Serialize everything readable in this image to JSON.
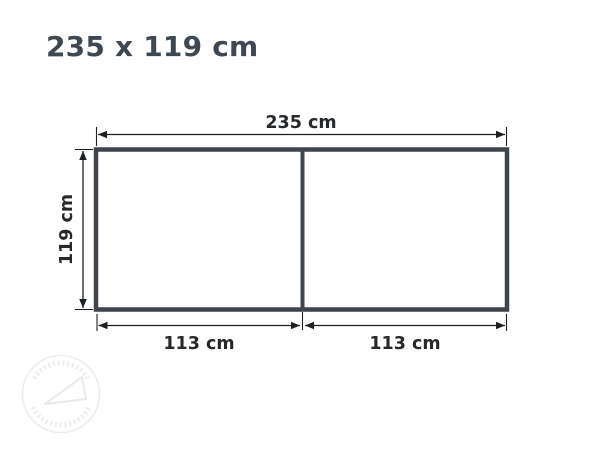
{
  "header": {
    "title": "235 x 119 cm"
  },
  "diagram": {
    "type": "dimension-drawing",
    "overall": {
      "width_cm": 235,
      "height_cm": 119
    },
    "sections": {
      "count": 2,
      "widths_cm": [
        113,
        113
      ]
    },
    "labels": {
      "width": "235 cm",
      "height": "119 cm",
      "section_left": "113 cm",
      "section_right": "113 cm"
    },
    "colors": {
      "outline": "#3f454c",
      "dimension_lines": "#1d1f22",
      "label_text": "#26292c",
      "title_text": "#3e4852",
      "watermark": "#ececec",
      "background": "#ffffff"
    }
  }
}
